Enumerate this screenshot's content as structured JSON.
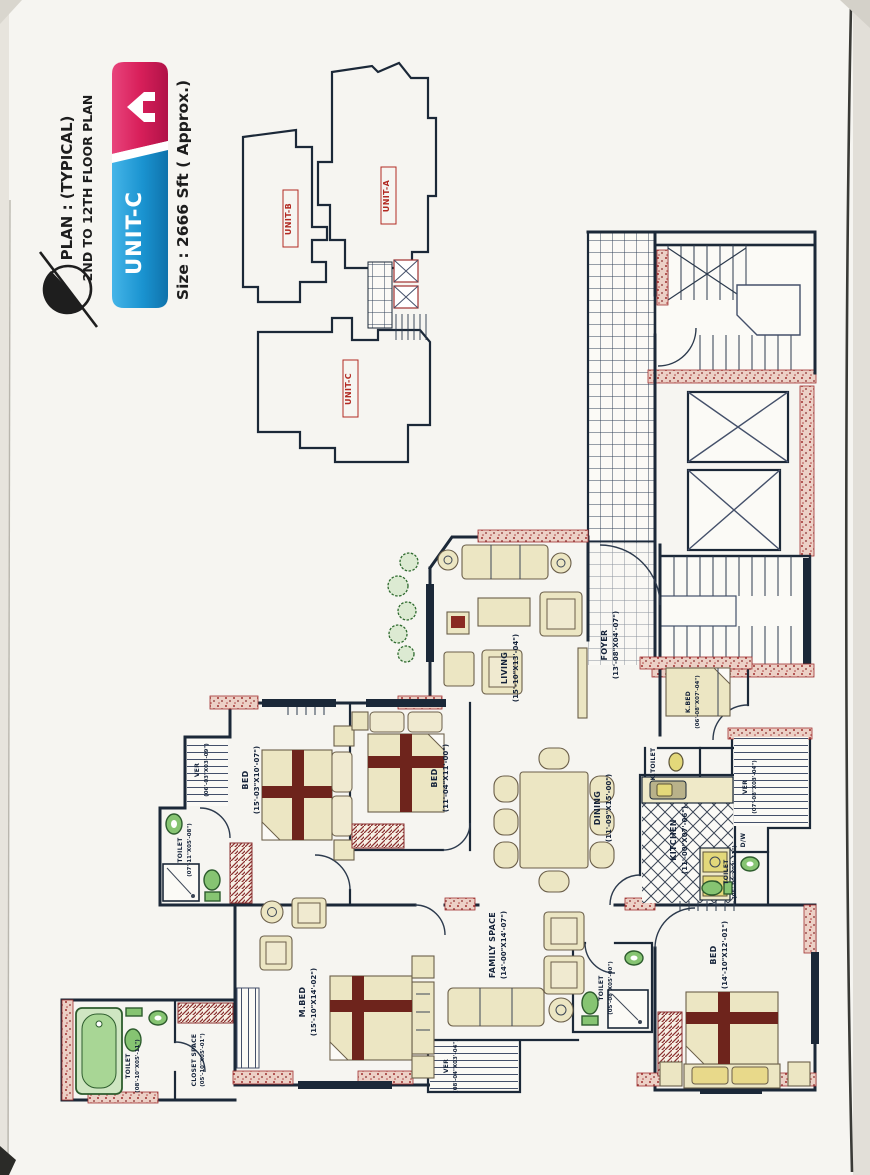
{
  "header": {
    "plan_title_line1": "PLAN : (TYPICAL)",
    "plan_title_line2": "2ND TO 12TH FLOOR PLAN",
    "unit_label": "UNIT-C",
    "size_label": "Size : 2666 Sft ( Approx.)"
  },
  "key_plan": {
    "unit_a": "UNIT-A",
    "unit_b": "UNIT-B",
    "unit_c": "UNIT-C"
  },
  "rooms": {
    "living": {
      "name": "LIVING",
      "dim": "(15'-10\"X13'-04\")"
    },
    "foyer": {
      "name": "FOYER",
      "dim": "(13'-08\"X04'-07\")"
    },
    "dining": {
      "name": "DINING",
      "dim": "(11'-09\"X15'-00\")"
    },
    "kitchen": {
      "name": "KITCHEN",
      "dim": "(11'-00\"X07'-06\")"
    },
    "kbed": {
      "name": "K.BED",
      "dim": "(06'-08\"X07'-04\")"
    },
    "ktoilet": {
      "name": "K.TOILET"
    },
    "ver_right": {
      "name": "VER",
      "dim": "(07'-08\"X03'-04\")"
    },
    "dw": {
      "name": "D/W"
    },
    "toilet_right": {
      "name": "TOILET",
      "dim": "(05'-00\"X03'-11\")"
    },
    "bed_right": {
      "name": "BED",
      "dim": "(14'-10\"X12'-01\")"
    },
    "toilet_family": {
      "name": "TOILET",
      "dim": "(05'-08\"X05'-00\")"
    },
    "family": {
      "name": "FAMILY SPACE",
      "dim": "(14'-00\"X14'-07\")"
    },
    "ver_bottom": {
      "name": "VER",
      "dim": "(08'-04\"X03'-04\")"
    },
    "mbed": {
      "name": "M.BED",
      "dim": "(15'-10\"X14'-02\")"
    },
    "toilet_master": {
      "name": "TOILET",
      "dim": "(08'-10\"X05'-11\")"
    },
    "closet": {
      "name": "CLOSET SPACE",
      "dim": "(05'-10\"X05'-01\")"
    },
    "toilet_left": {
      "name": "TOILET",
      "dim": "(07'-11\"X05'-08\")"
    },
    "ver_left": {
      "name": "VER",
      "dim": "(06'-03\"X03'-09\")"
    },
    "bed_left": {
      "name": "BED",
      "dim": "(15'-03\"X10'-07\")"
    },
    "bed_mid": {
      "name": "BED",
      "dim": "(11'-04\"X11'-00\")"
    }
  },
  "colors": {
    "banner_red": "#d81f5a",
    "banner_blue": "#1a93d0",
    "wall_navy": "#1b2838",
    "accent_red": "#a83428",
    "fixture_green": "#86c472",
    "furniture_khaki": "#ece6c3",
    "key_label_red": "#b22a22"
  }
}
